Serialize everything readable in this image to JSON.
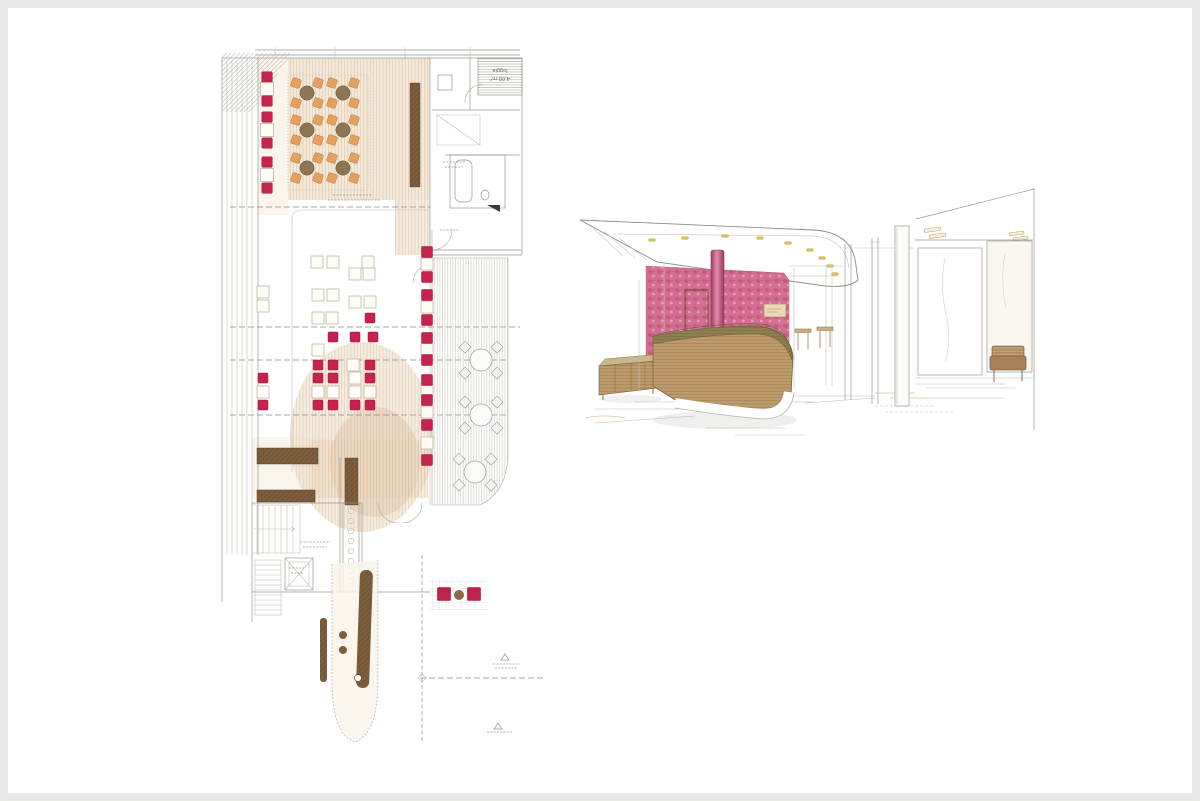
{
  "page": {
    "kind": "architectural presentation scan",
    "left_drawing": "restaurant floor plan (colored pencil)",
    "right_drawing": "interior perspective of reception desk (colored pencil)"
  },
  "colors": {
    "frame": "#e9e9e7",
    "paper": "#ffffff",
    "crimson": "#c5234e",
    "crimsonDark": "#97173a",
    "orange": "#e3a05f",
    "tableBrown": "#8d7453",
    "darkBrown": "#7d5e3c",
    "darkBrownEdge": "#5d4227",
    "tanWash": "#ead9bf",
    "tanStroke": "#c89d72",
    "pink": "#d2678c",
    "pinkDark": "#a83a64",
    "pinkLight": "#e9aac2",
    "wood": "#bd9c6e",
    "woodDark": "#8a6b42",
    "olive": "#8d7f52",
    "gold": "#d9c158",
    "line": "#9a968e",
    "lineLight": "#c2beb5",
    "pencil": "#8f8b84"
  },
  "floor_plan": {
    "labels": {
      "loggia": "loggia",
      "loggia_area": "4,00 m²"
    },
    "round_tables": [
      [
        92,
        51
      ],
      [
        128,
        51
      ],
      [
        92,
        88
      ],
      [
        128,
        88
      ],
      [
        92,
        126
      ],
      [
        128,
        126
      ]
    ],
    "left_bench": {
      "cx": 52,
      "items": [
        {
          "t": "seat",
          "y": 35
        },
        {
          "t": "table",
          "y": 47
        },
        {
          "t": "seat",
          "y": 59
        },
        {
          "t": "seat",
          "y": 75
        },
        {
          "t": "table",
          "y": 88
        },
        {
          "t": "seat",
          "y": 101
        },
        {
          "t": "seat",
          "y": 120
        },
        {
          "t": "table",
          "y": 133
        },
        {
          "t": "seat",
          "y": 146
        }
      ]
    },
    "dining": {
      "tables": [
        [
          102,
          220
        ],
        [
          118,
          220
        ],
        [
          153,
          220
        ],
        [
          140,
          232
        ],
        [
          154,
          232
        ],
        [
          103,
          253
        ],
        [
          118,
          253
        ],
        [
          140,
          260
        ],
        [
          155,
          260
        ],
        [
          103,
          276
        ],
        [
          117,
          276
        ],
        [
          48,
          250
        ],
        [
          48,
          264
        ],
        [
          103,
          308
        ],
        [
          138,
          323
        ],
        [
          140,
          336
        ],
        [
          48,
          350
        ],
        [
          103,
          350
        ],
        [
          118,
          350
        ],
        [
          140,
          350
        ],
        [
          155,
          350
        ]
      ],
      "seats": [
        [
          155,
          276
        ],
        [
          118,
          295
        ],
        [
          140,
          295
        ],
        [
          158,
          295
        ],
        [
          103,
          323
        ],
        [
          118,
          323
        ],
        [
          155,
          323
        ],
        [
          48,
          336
        ],
        [
          103,
          336
        ],
        [
          118,
          336
        ],
        [
          155,
          336
        ],
        [
          48,
          363
        ],
        [
          103,
          363
        ],
        [
          118,
          363
        ],
        [
          140,
          363
        ],
        [
          155,
          363
        ]
      ]
    },
    "right_row": {
      "cx": 212,
      "seats": [
        210,
        235,
        253,
        278,
        296,
        318,
        338,
        358,
        383,
        418
      ],
      "tables": [
        222,
        265,
        307,
        348,
        370,
        401
      ]
    },
    "terrace_tables": [
      [
        266,
        318
      ],
      [
        266,
        373
      ],
      [
        260,
        430
      ]
    ],
    "lounge": {
      "seats": [
        [
          229,
          552
        ],
        [
          259,
          552
        ]
      ],
      "table": [
        244,
        553
      ]
    }
  },
  "perspective": {
    "ceiling_lights": [
      [
        77,
        52
      ],
      [
        110,
        50
      ],
      [
        150,
        48
      ],
      [
        185,
        50
      ],
      [
        213,
        55
      ],
      [
        235,
        62
      ],
      [
        247,
        70
      ],
      [
        255,
        78
      ],
      [
        260,
        86
      ]
    ]
  }
}
